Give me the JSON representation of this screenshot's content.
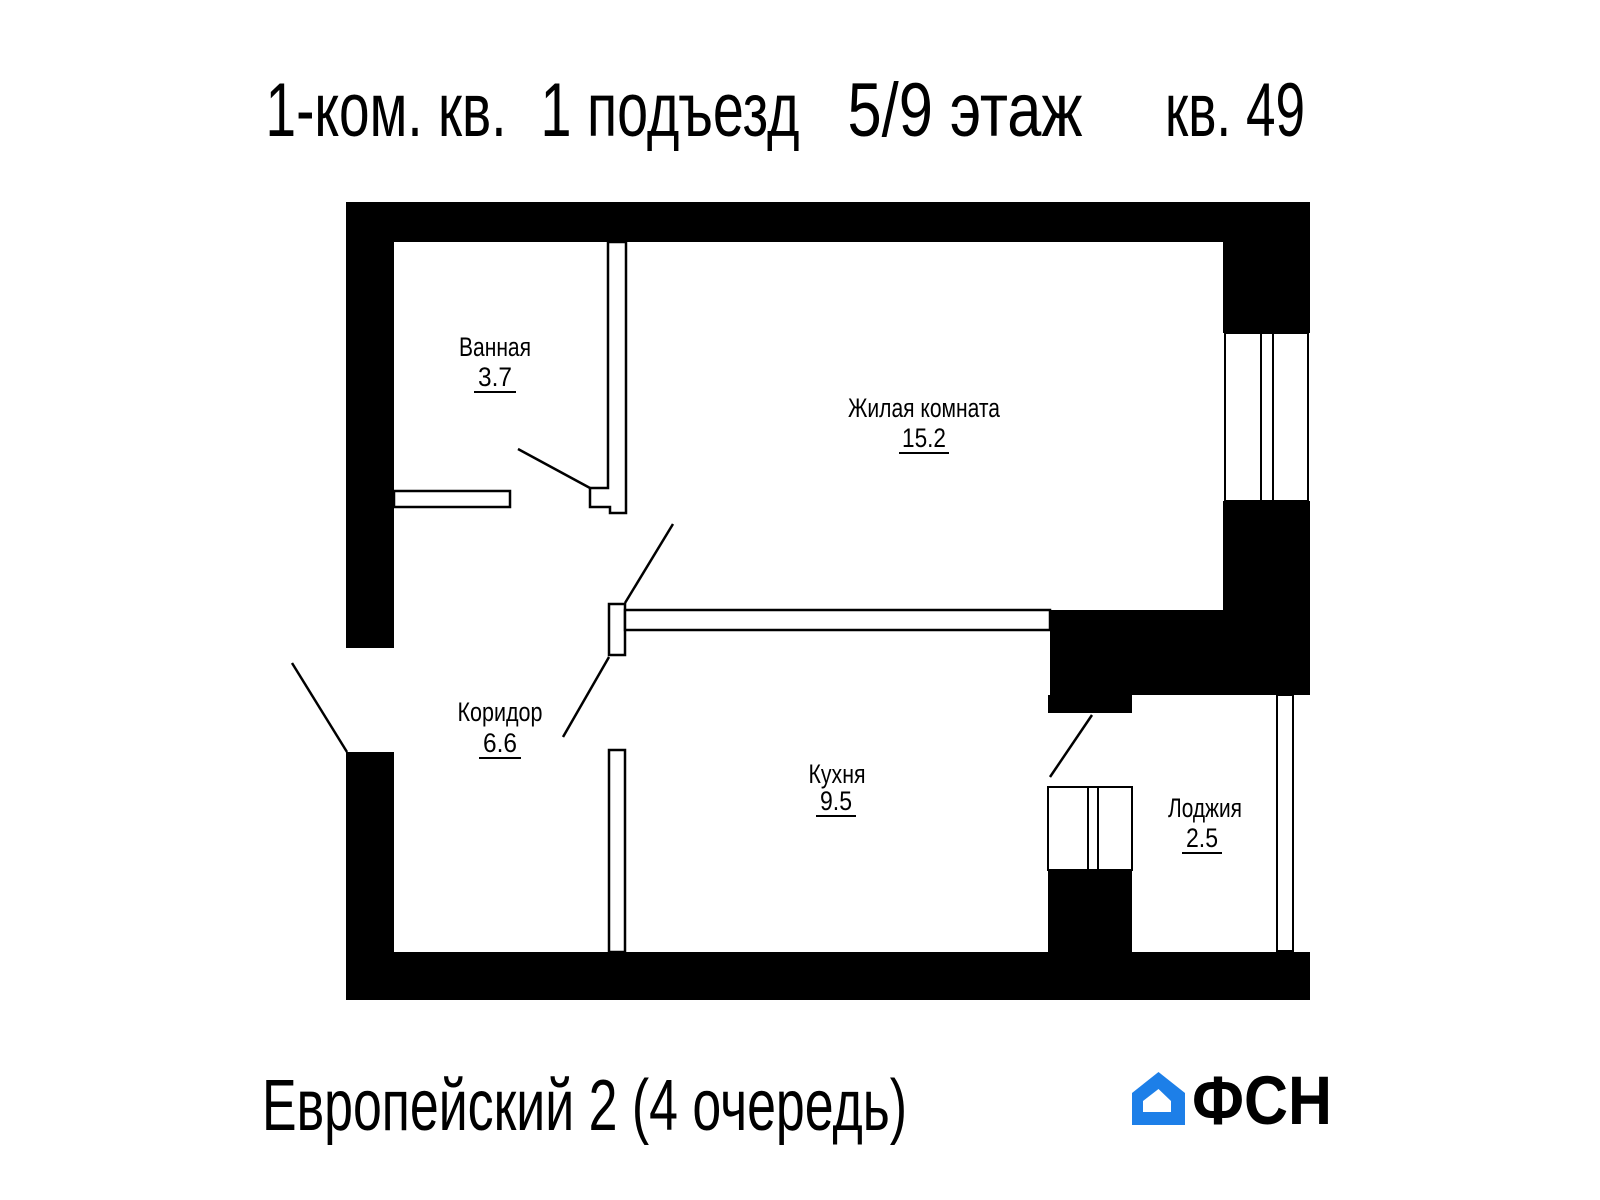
{
  "header": {
    "title_parts": [
      "1-ком. кв.",
      "1 подъезд",
      "5/9 этаж",
      "кв. 49"
    ]
  },
  "rooms": [
    {
      "name": "Ванная",
      "area": "3.7"
    },
    {
      "name": "Жилая комната",
      "area": "15.2"
    },
    {
      "name": "Коридор",
      "area": "6.6"
    },
    {
      "name": "Кухня",
      "area": "9.5"
    },
    {
      "name": "Лоджия",
      "area": "2.5"
    }
  ],
  "footer": {
    "project_name": "Европейский 2 (4 очередь)",
    "logo_text": "ФСН"
  },
  "colors": {
    "walls": "#000000",
    "logo_blue": "#1d7fe8",
    "logo_dark": "#212121"
  }
}
